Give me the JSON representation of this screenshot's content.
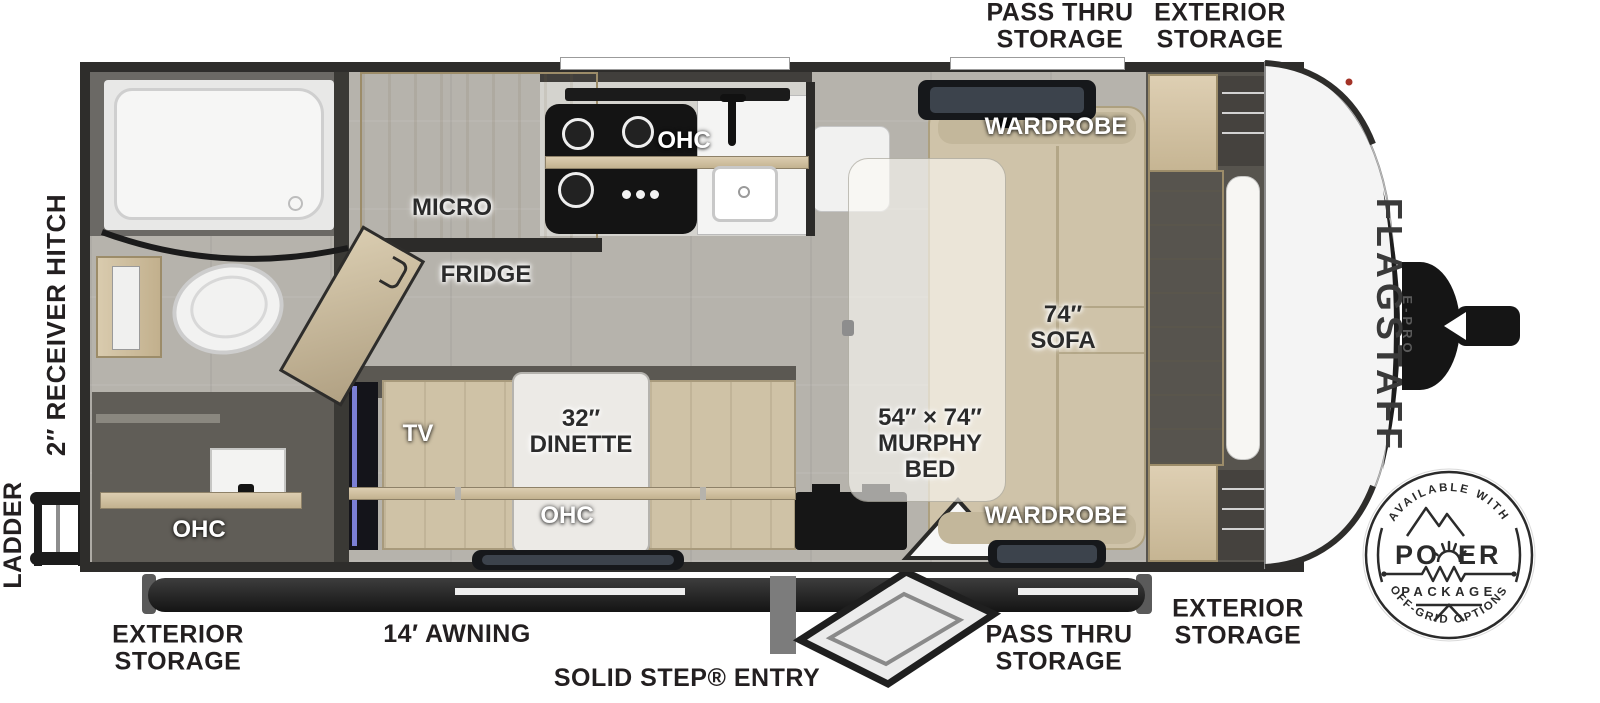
{
  "plan": {
    "brand": "FLAGSTAFF",
    "sub_brand": "E-PRO"
  },
  "exterior_labels": {
    "top_pass_thru": "PASS THRU\nSTORAGE",
    "top_exterior": "EXTERIOR\nSTORAGE",
    "receiver_hitch": "2″ RECEIVER HITCH",
    "ladder": "LADDER",
    "bottom_exterior_left": "EXTERIOR\nSTORAGE",
    "awning": "14′ AWNING",
    "entry": "SOLID STEP® ENTRY",
    "bottom_pass_thru": "PASS THRU\nSTORAGE",
    "bottom_exterior_right": "EXTERIOR\nSTORAGE"
  },
  "room_labels": {
    "micro": "MICRO",
    "fridge": "FRIDGE",
    "kitchen_ohc": "OHC",
    "bath_ohc": "OHC",
    "tv": "TV",
    "dinette": "32″\nDINETTE",
    "dinette_ohc": "OHC",
    "murphy_bed": "54″ × 74″\nMURPHY\nBED",
    "sofa": "74″\nSOFA",
    "wardrobe_top": "WARDROBE",
    "wardrobe_bottom": "WARDROBE"
  },
  "badge": {
    "top": "AVAILABLE WITH",
    "power_left": "PO",
    "power_right": "ER",
    "package": "PACKAGE",
    "bottom": "OFF-GRID OPTIONS"
  },
  "colors": {
    "wall": "#2e2d2b",
    "floor": "#b7b4ad",
    "wood": "#d6c9ad",
    "sofa": "#cfc3a9",
    "accent_dark": "#161616"
  }
}
